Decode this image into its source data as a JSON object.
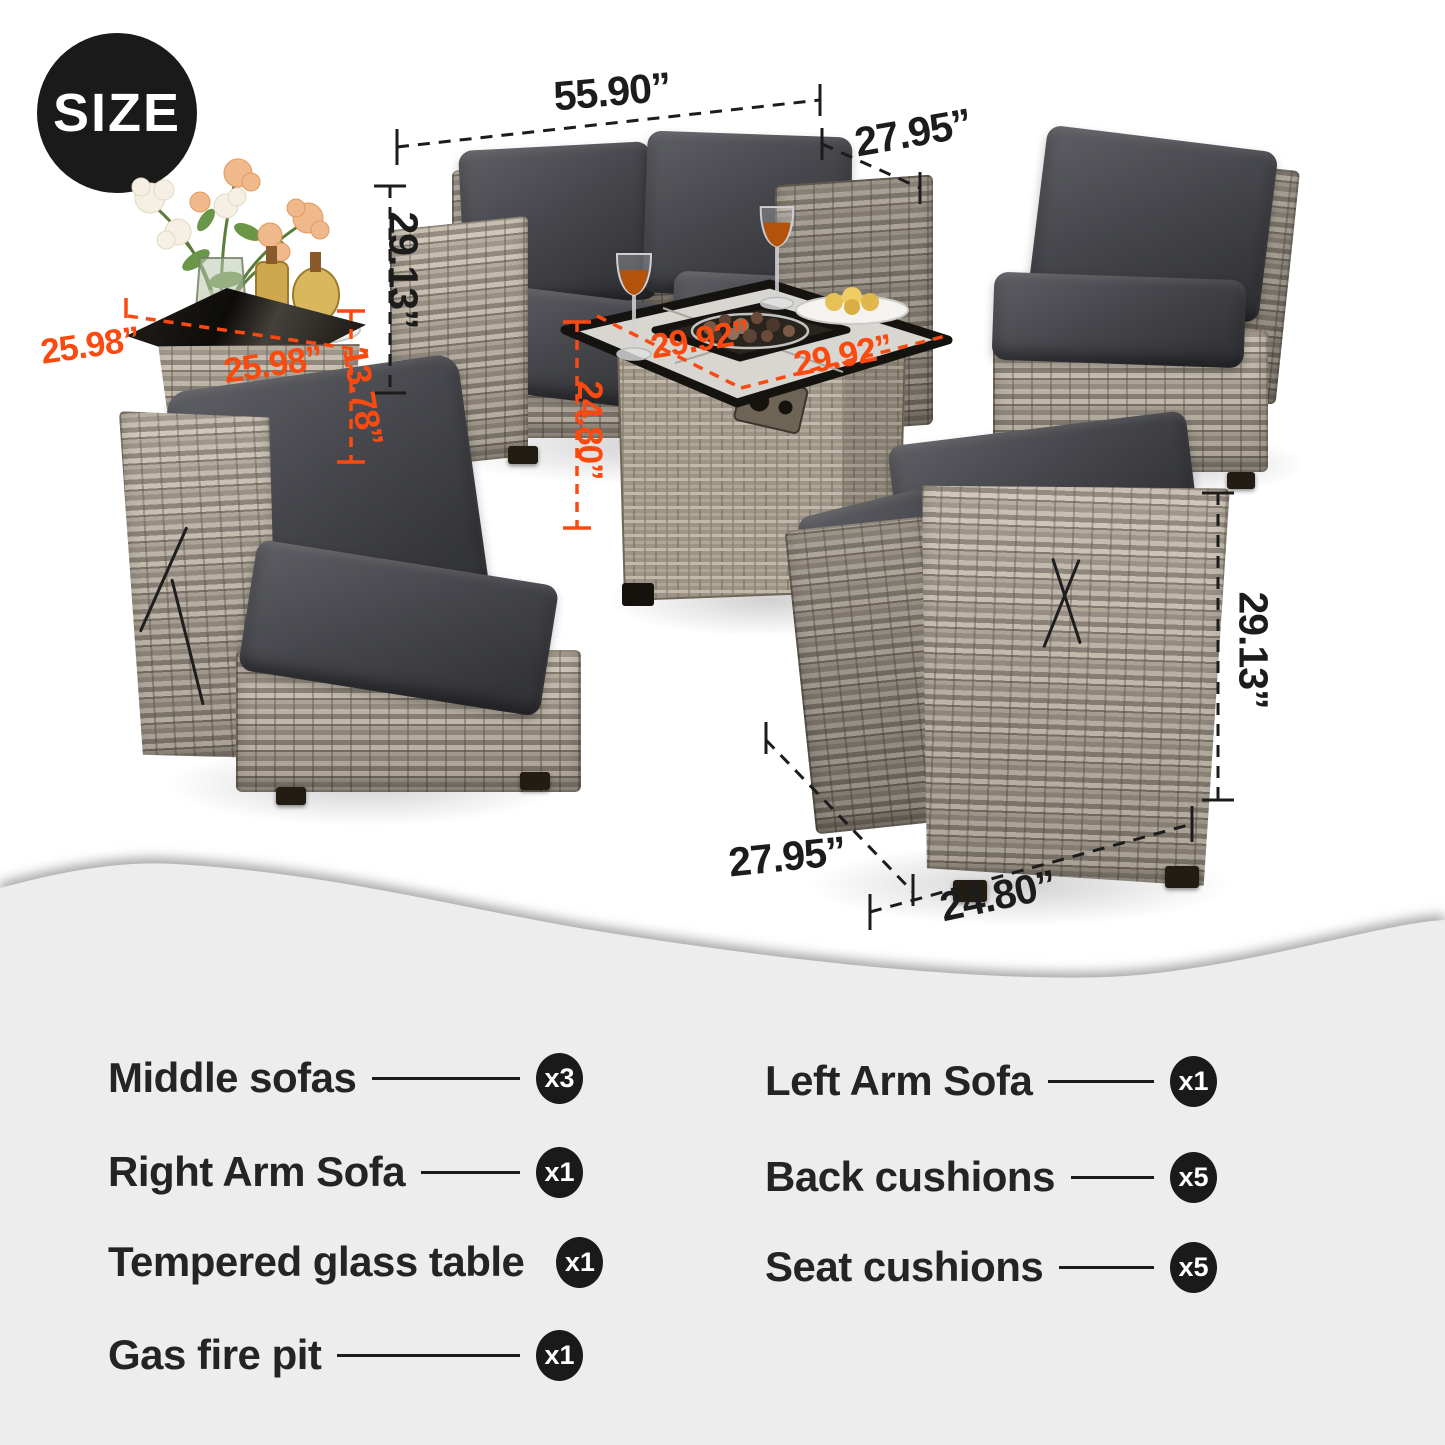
{
  "badge": {
    "label": "SIZE"
  },
  "annotations": {
    "loveseat_width": "55.90”",
    "loveseat_depth": "27.95”",
    "loveseat_height": "29.13”",
    "side_table_depth": "25.98”",
    "side_table_width": "25.98”",
    "side_table_height": "13.78”",
    "fire_table_width": "29.92”",
    "fire_table_depth": "29.92”",
    "fire_table_height": "24.80”",
    "corner_chair_height": "29.13”",
    "corner_chair_depth": "27.95”",
    "corner_chair_width": "24.80”"
  },
  "parts_list": {
    "left_column": [
      {
        "label": "Middle sofas",
        "count": "x3"
      },
      {
        "label": "Right Arm Sofa",
        "count": "x1"
      },
      {
        "label": "Tempered glass table",
        "count": "x1"
      },
      {
        "label": "Gas fire pit",
        "count": "x1"
      }
    ],
    "right_column": [
      {
        "label": "Left Arm Sofa",
        "count": "x1"
      },
      {
        "label": "Back cushions",
        "count": "x5"
      },
      {
        "label": "Seat cushions",
        "count": "x5"
      }
    ]
  },
  "colors": {
    "accent_orange": "#fb4a10",
    "ink": "#1c1c1c",
    "badge_bg": "#1a1a1a",
    "panel_bg": "#ededed"
  }
}
